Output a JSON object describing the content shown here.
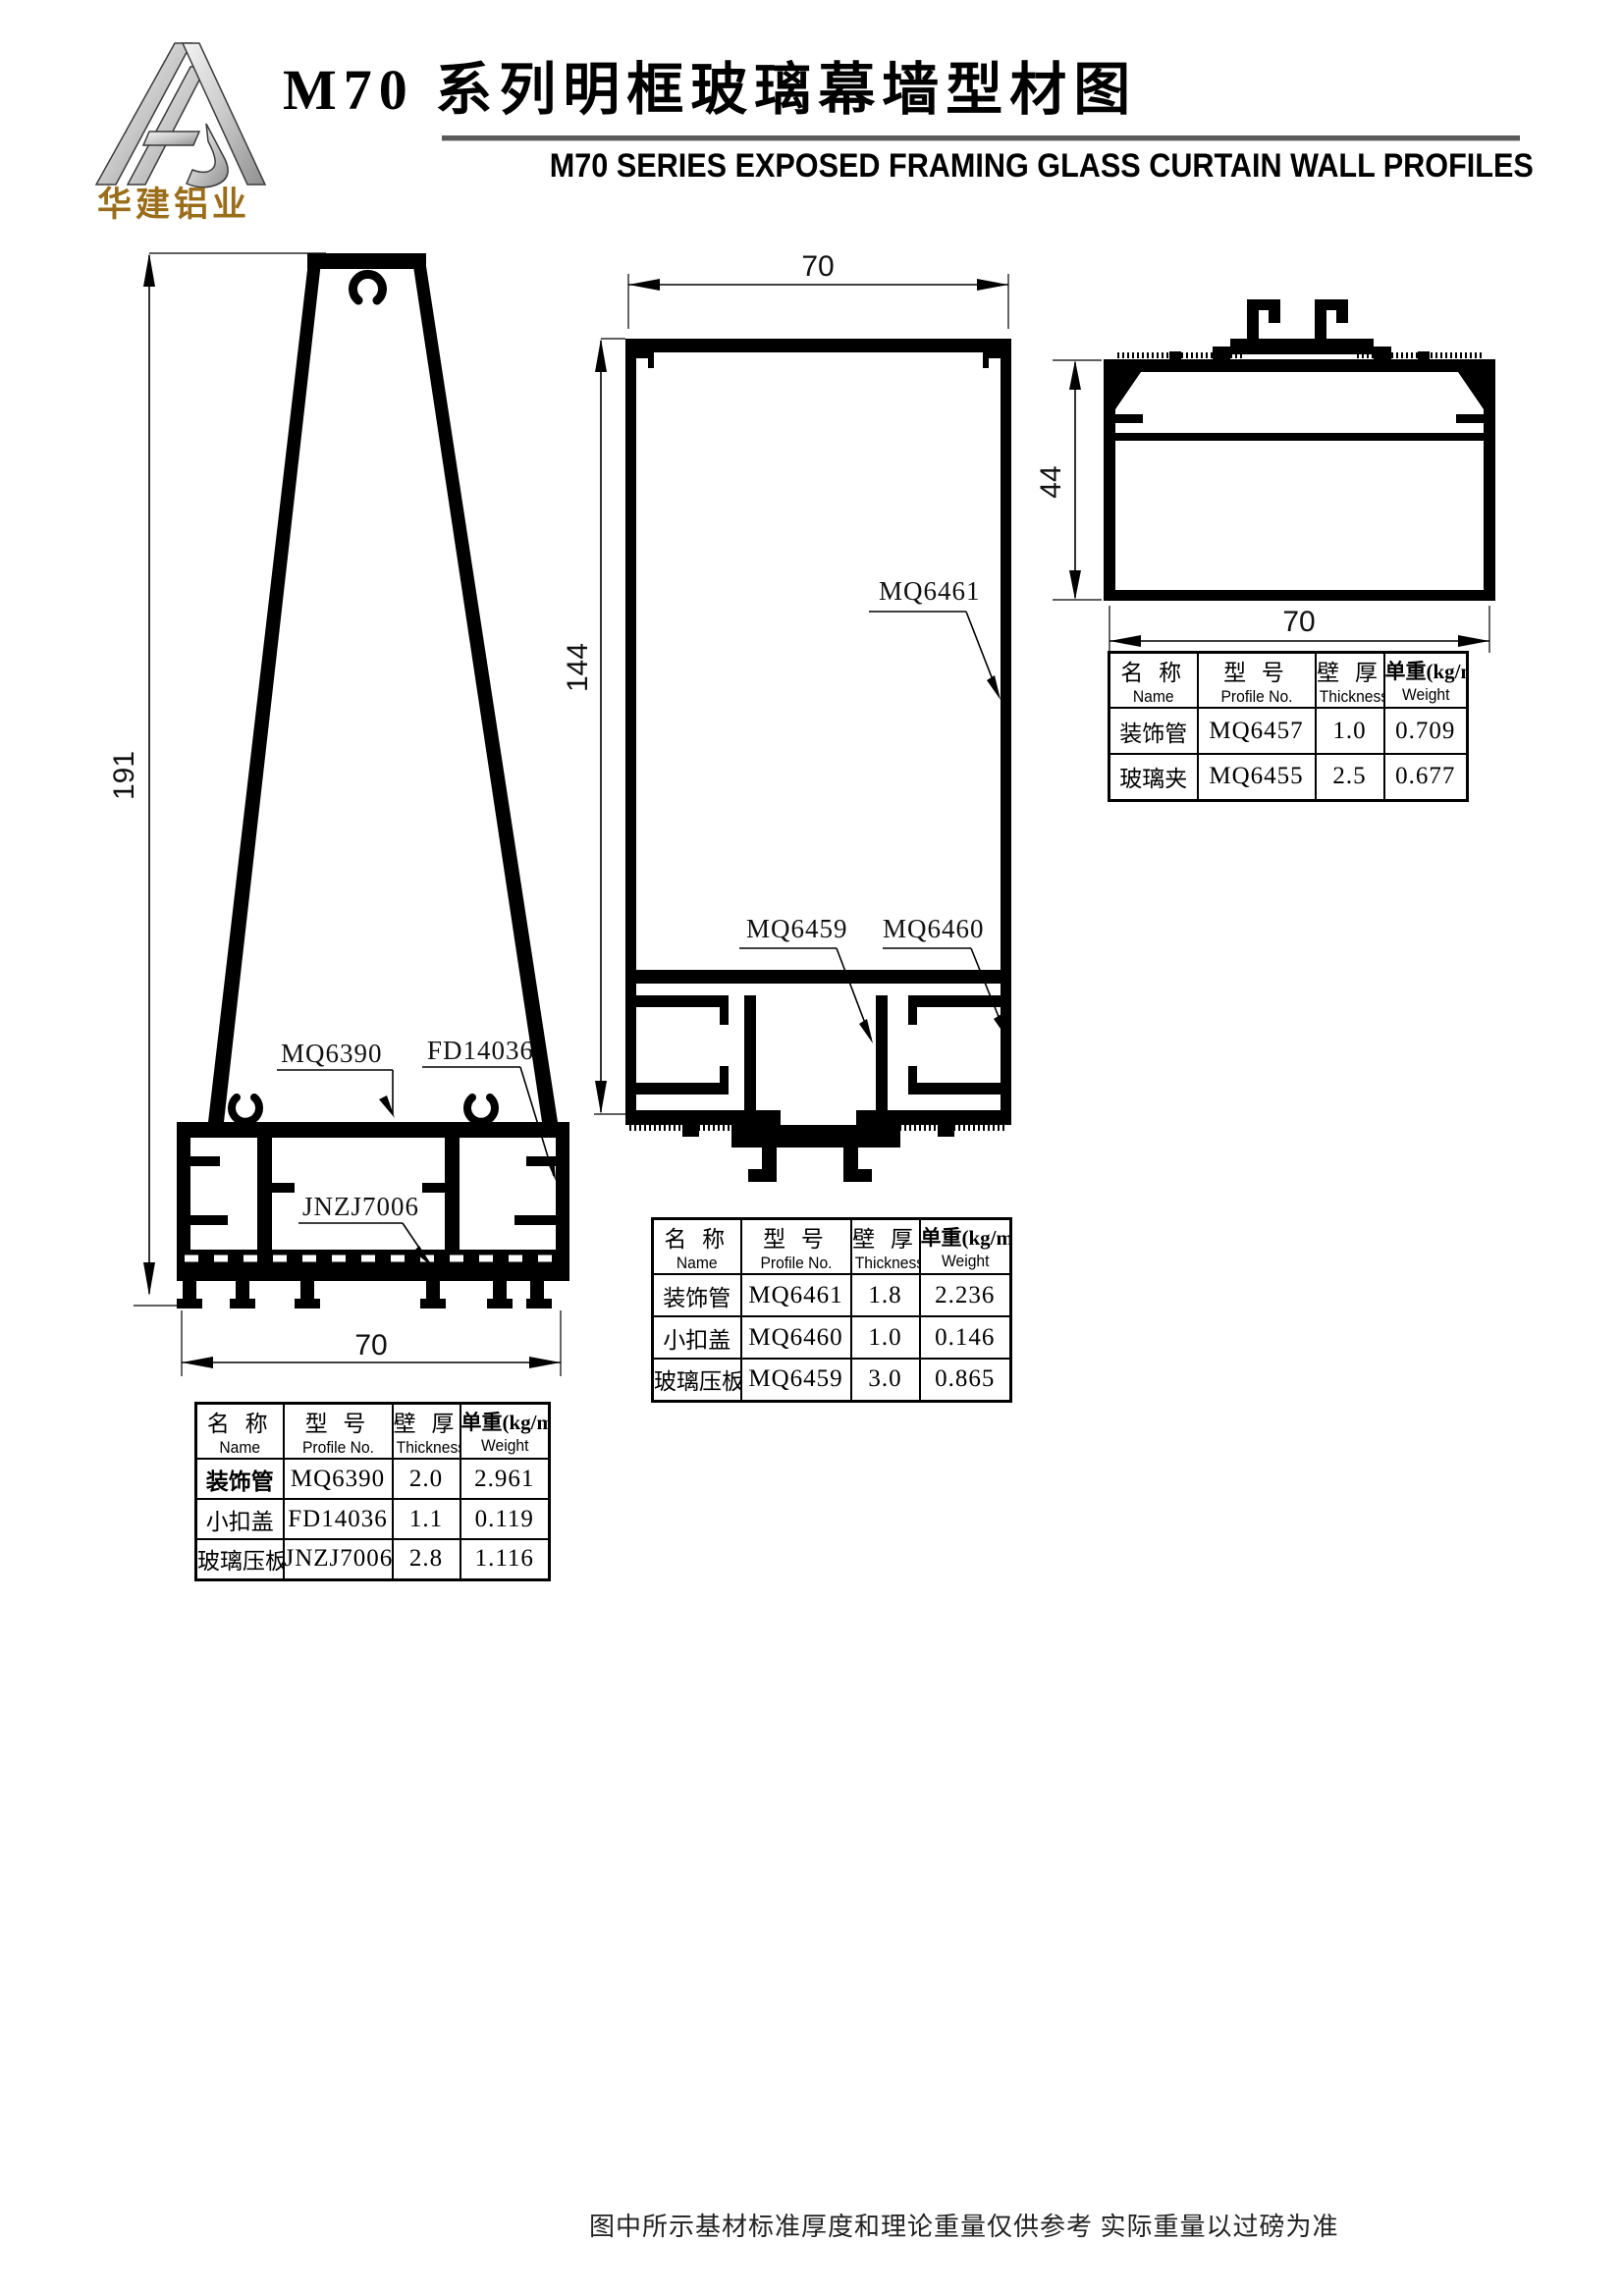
{
  "header": {
    "logo_text": "华建铝业",
    "title_cn": "M70 系列明框玻璃幕墙型材图",
    "title_en": "M70 SERIES EXPOSED FRAMING GLASS CURTAIN WALL PROFILES"
  },
  "table_headers": {
    "name_cn": "名 称",
    "name_en": "Name",
    "profile_cn": "型 号",
    "profile_en": "Profile No.",
    "thickness_cn": "壁 厚",
    "thickness_en": "Thickness",
    "weight_cn": "单重(kg/m)",
    "weight_en": "Weight"
  },
  "drawings": {
    "mullion": {
      "height_dim": "191",
      "width_dim": "70",
      "label_body": "MQ6390",
      "label_cap": "FD14036",
      "label_clamp": "JNZJ7006"
    },
    "transom": {
      "width_dim": "70",
      "height_dim": "144",
      "label_tube": "MQ6461",
      "label_plate": "MQ6459",
      "label_cover": "MQ6460"
    },
    "side": {
      "height_dim": "44",
      "width_dim": "70"
    }
  },
  "tables": {
    "mullion": {
      "rows": [
        {
          "name": "装饰管",
          "profile": "MQ6390",
          "thickness": "2.0",
          "weight": "2.961"
        },
        {
          "name": "小扣盖",
          "profile": "FD14036",
          "thickness": "1.1",
          "weight": "0.119"
        },
        {
          "name": "玻璃压板",
          "profile": "JNZJ7006",
          "thickness": "2.8",
          "weight": "1.116"
        }
      ]
    },
    "transom": {
      "rows": [
        {
          "name": "装饰管",
          "profile": "MQ6461",
          "thickness": "1.8",
          "weight": "2.236"
        },
        {
          "name": "小扣盖",
          "profile": "MQ6460",
          "thickness": "1.0",
          "weight": "0.146"
        },
        {
          "name": "玻璃压板",
          "profile": "MQ6459",
          "thickness": "3.0",
          "weight": "0.865"
        }
      ]
    },
    "side": {
      "rows": [
        {
          "name": "装饰管",
          "profile": "MQ6457",
          "thickness": "1.0",
          "weight": "0.709"
        },
        {
          "name": "玻璃夹",
          "profile": "MQ6455",
          "thickness": "2.5",
          "weight": "0.677"
        }
      ]
    }
  },
  "footer": {
    "note": "图中所示基材标准厚度和理论重量仅供参考  实际重量以过磅为准"
  }
}
